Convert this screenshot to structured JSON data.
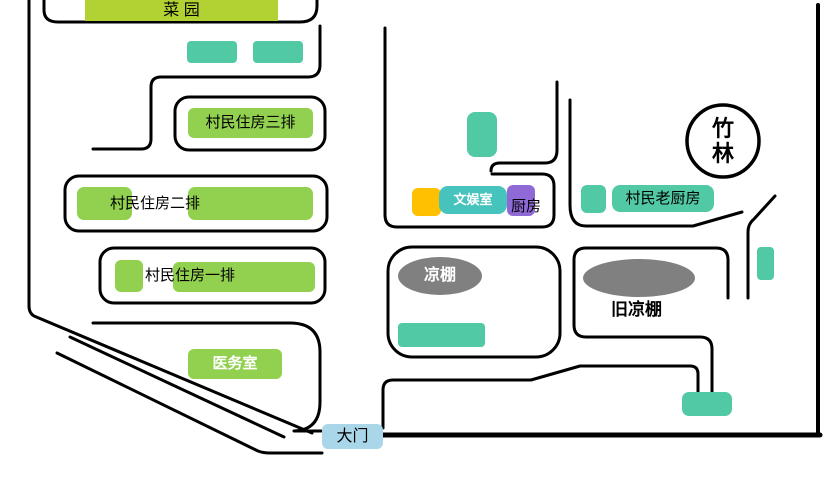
{
  "map": {
    "title": "village-layout-sketch-map",
    "labels": {
      "vegetable_garden": "菜 园",
      "housing_row3": "村民住房三排",
      "housing_row2": "村民住房二排",
      "housing_row1": "村民住房一排",
      "clinic": "医务室",
      "gate": "大门",
      "recreation_room": "文娱室",
      "kitchen": "厨房",
      "old_villager_kitchen": "村民老厨房",
      "shade_shed": "凉棚",
      "old_shade_shed": "旧凉棚",
      "bamboo": {
        "line1": "竹",
        "line2": "林"
      }
    },
    "colors": {
      "building_green": "#92d050",
      "garden_green": "#b2d233",
      "teal_block": "#52c9a5",
      "recreation_teal": "#45c3bc",
      "kitchen_purple": "#8f6ad6",
      "storage_yellow": "#ffc001",
      "shed_gray": "#808080",
      "gate_blue": "#a9d6e8",
      "road_black": "#000000"
    }
  }
}
